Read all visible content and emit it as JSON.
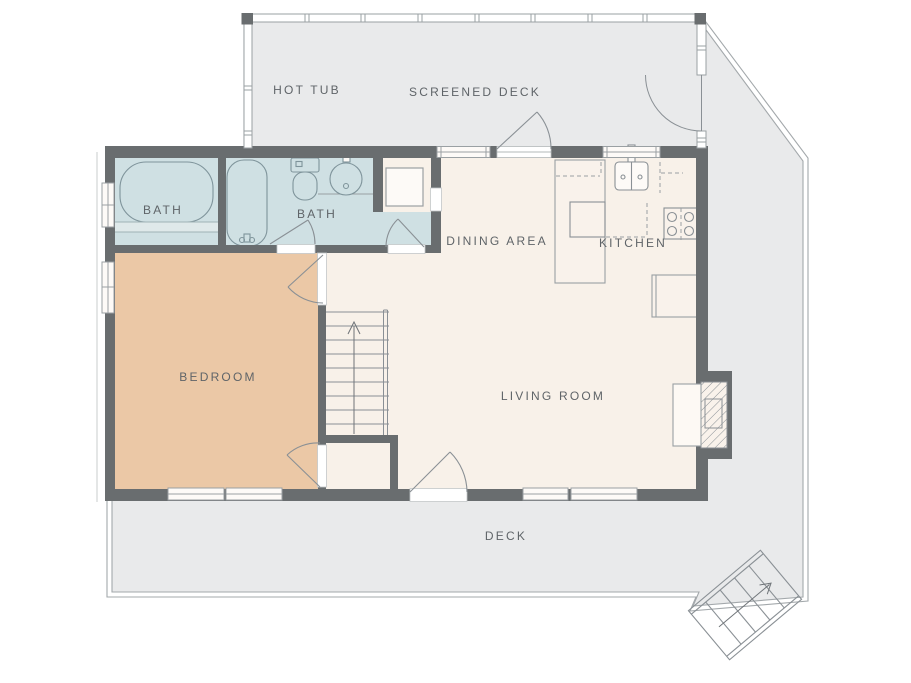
{
  "floor_plan": {
    "type": "residential-floor-plan",
    "rooms": [
      {
        "name": "hot-tub",
        "label": "HOT TUB"
      },
      {
        "name": "screened-deck",
        "label": "SCREENED DECK"
      },
      {
        "name": "bath-1",
        "label": "BATH"
      },
      {
        "name": "bath-2",
        "label": "BATH"
      },
      {
        "name": "dining-area",
        "label": "DINING AREA"
      },
      {
        "name": "kitchen",
        "label": "KITCHEN"
      },
      {
        "name": "bedroom",
        "label": "BEDROOM"
      },
      {
        "name": "living-room",
        "label": "LIVING ROOM"
      },
      {
        "name": "deck",
        "label": "DECK"
      }
    ],
    "fixtures": [
      "soaking-tub",
      "bathtub",
      "toilet",
      "sink",
      "shower",
      "kitchen-sink",
      "stove",
      "kitchen-island",
      "kitchen-counter",
      "fireplace",
      "interior-stairs",
      "exterior-stairs"
    ],
    "colors": {
      "background": "#ffffff",
      "deck": "#e9eaeb",
      "house_floor": "#f8f1e9",
      "bath_floor": "#cfe0e3",
      "bedroom_floor": "#ebc8a6",
      "wall": "#696d6f",
      "fixture_line": "#8a9095",
      "edge_line": "#a3a8ab",
      "label_text": "#5f6468"
    }
  }
}
